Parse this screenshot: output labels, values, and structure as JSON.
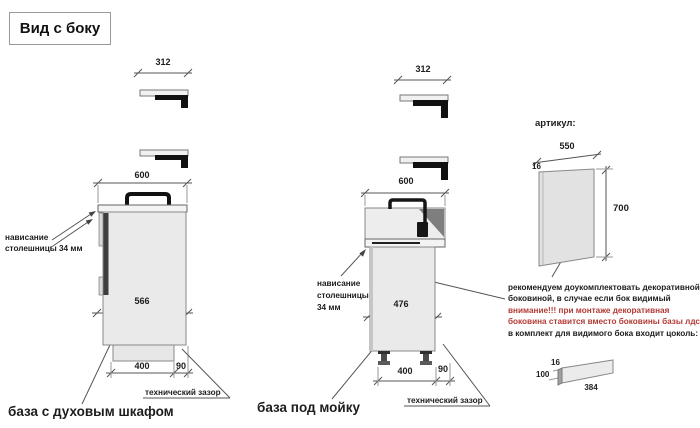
{
  "title": "Вид с боку",
  "colors": {
    "warning_red": "#b23a35",
    "line_gray": "#555555",
    "cabinet_fill": "#eaeaea",
    "profile_black": "#111111"
  },
  "oven_base": {
    "name": "база с духовым шкафом",
    "dims": {
      "countertop_profile_width": "312",
      "top_width": "600",
      "body_depth": "566",
      "plinth_depth": "400",
      "tech_gap": "90"
    },
    "overhang_note_line1": "нависание",
    "overhang_note_line2": "столешницы 34 мм",
    "gap_label": "технический зазор"
  },
  "sink_base": {
    "name": "база под мойку",
    "dims": {
      "countertop_profile_width": "312",
      "top_width": "600",
      "body_depth": "476",
      "plinth_depth": "400",
      "tech_gap": "90"
    },
    "overhang_note_line1": "нависание",
    "overhang_note_line2": "столешницы",
    "overhang_note_line3": "34 мм",
    "gap_label": "технический зазор"
  },
  "side_panel": {
    "heading": "артикул:",
    "dims": {
      "width": "550",
      "thickness": "16",
      "height": "700"
    },
    "note_line1": "рекомендуем доукомплектовать декоративной",
    "note_line2": "боковиной, в случае если бок видимый",
    "note_line3": "внимание!!! при монтаже декоративная",
    "note_line4": "боковина ставится вместо боковины базы лдсп",
    "note_line5": "в комплект для видимого бока входит цоколь:",
    "plinth": {
      "thickness": "16",
      "height": "100",
      "length": "384"
    }
  }
}
